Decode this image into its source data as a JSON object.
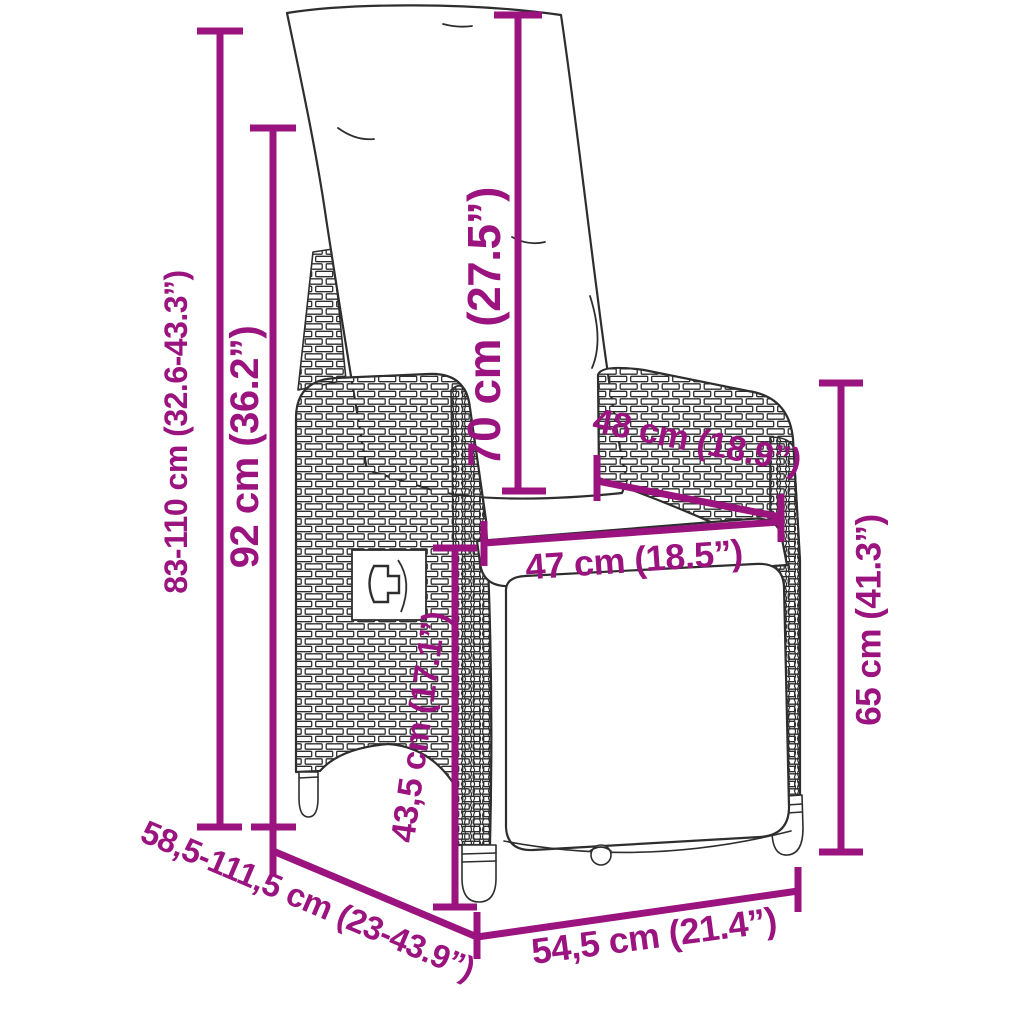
{
  "page": {
    "background": "#FFFFFF"
  },
  "diagram": {
    "subject": "reclining-garden-wicker-chair-with-back-cushion",
    "accent_color": "#9A137F",
    "line_color": "#2E2E2E",
    "dimensions": [
      {
        "id": "total-height-range",
        "label": "83-110 cm (32.6-43.3”)"
      },
      {
        "id": "backrest-height",
        "label": "92 cm (36.2”)"
      },
      {
        "id": "back-cushion-height",
        "label": "70 cm (27.5”)"
      },
      {
        "id": "inner-back-width",
        "label": "48 cm (18.9”)"
      },
      {
        "id": "seat-width",
        "label": "47 cm (18.5”)"
      },
      {
        "id": "armrest-height",
        "label": "65 cm (41.3”)"
      },
      {
        "id": "seat-height",
        "label": "43,5 cm (17.1”)"
      },
      {
        "id": "depth-range",
        "label": "58,5-111,5 cm (23-43.9”)"
      },
      {
        "id": "base-width",
        "label": "54,5 cm (21.4”)"
      }
    ]
  }
}
